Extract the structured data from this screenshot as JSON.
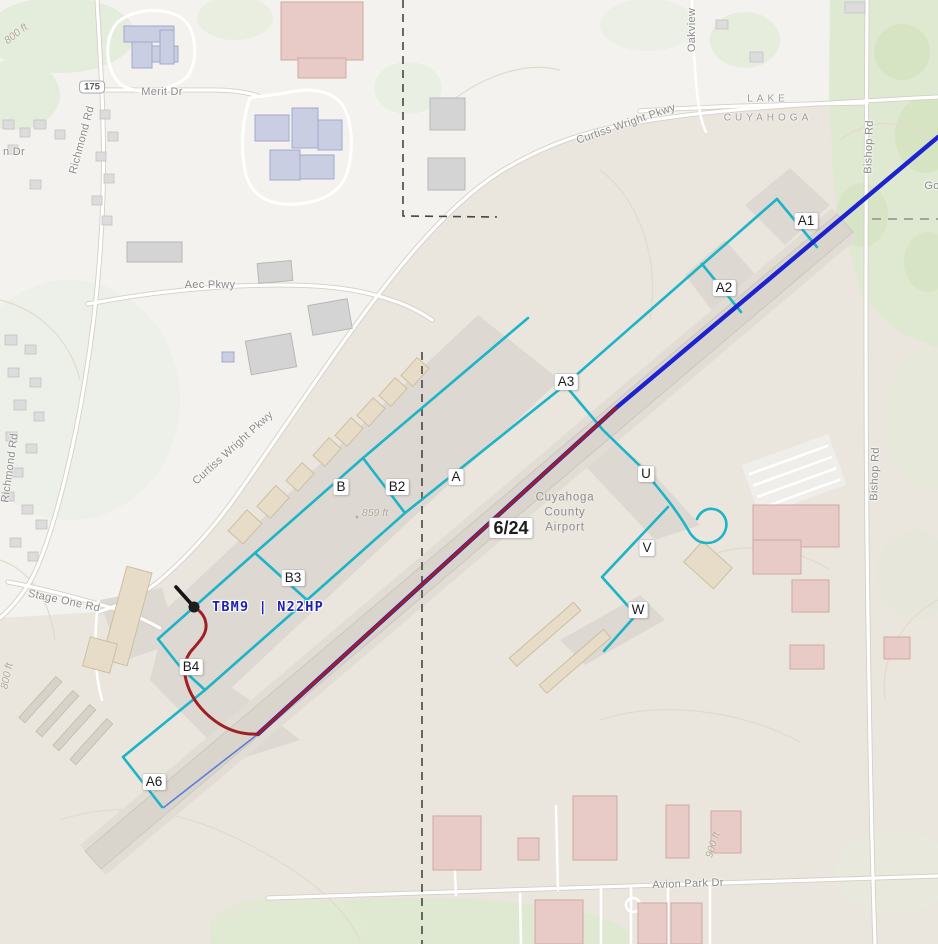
{
  "app": {
    "type": "airport-ground-track-map"
  },
  "airport": {
    "name_lines": [
      "Cuyahoga",
      "County",
      "Airport"
    ],
    "runway_label": "6/24"
  },
  "aircraft": {
    "label": "TBM9 | N22HP",
    "type": "TBM9",
    "registration": "N22HP"
  },
  "taxiway_labels": [
    "A1",
    "A2",
    "A3",
    "A",
    "B",
    "B2",
    "B3",
    "B4",
    "A6",
    "U",
    "V",
    "W"
  ],
  "counties": {
    "north": "LAKE",
    "south": "CUYAHOGA"
  },
  "roads": {
    "merit": "Merit Dr",
    "aec": "Aec Pkwy",
    "richmond": "Richmond Rd",
    "curtiss": "Curtiss Wright Pkwy",
    "bishop": "Bishop Rd",
    "oakview": "Oakview",
    "stage_one": "Stage One Rd",
    "avion": "Avion Park Dr",
    "partial_n_dr": "n Dr",
    "partial_go": "Go",
    "route_shield": "175"
  },
  "elevation_labels": {
    "e800": "800 ft",
    "e859": "859 ft",
    "e900": "900 ft"
  },
  "colors": {
    "airborne_track": "#1c23cf",
    "ground_track": "#9e1f24",
    "taxiway": "#1cb4c6",
    "aircraft_label": "#2020b2",
    "runway_pavement": "#d9d5cd"
  }
}
